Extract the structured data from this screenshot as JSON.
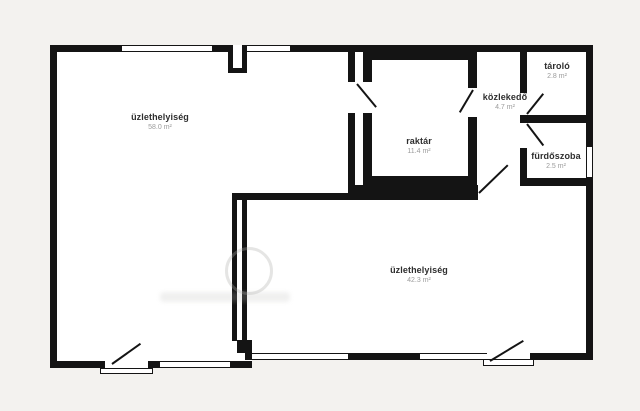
{
  "plan": {
    "rooms": [
      {
        "id": "shop-left",
        "name": "üzlethelyiség",
        "area": "58.0 m²"
      },
      {
        "id": "storage",
        "name": "raktár",
        "area": "11.4 m²"
      },
      {
        "id": "hallway",
        "name": "közlekedő",
        "area": "4.7 m²"
      },
      {
        "id": "store-room",
        "name": "tároló",
        "area": "2.8 m²"
      },
      {
        "id": "bathroom",
        "name": "fürdőszoba",
        "area": "2.5 m²"
      },
      {
        "id": "shop-bottom",
        "name": "üzlethelyiség",
        "area": "42.3 m²"
      }
    ],
    "colors": {
      "wall": "#141414",
      "floor": "#ffffff",
      "background": "#f3f2ef",
      "room_name_text": "#2e2e2e",
      "area_text": "#9b9b9b"
    }
  }
}
